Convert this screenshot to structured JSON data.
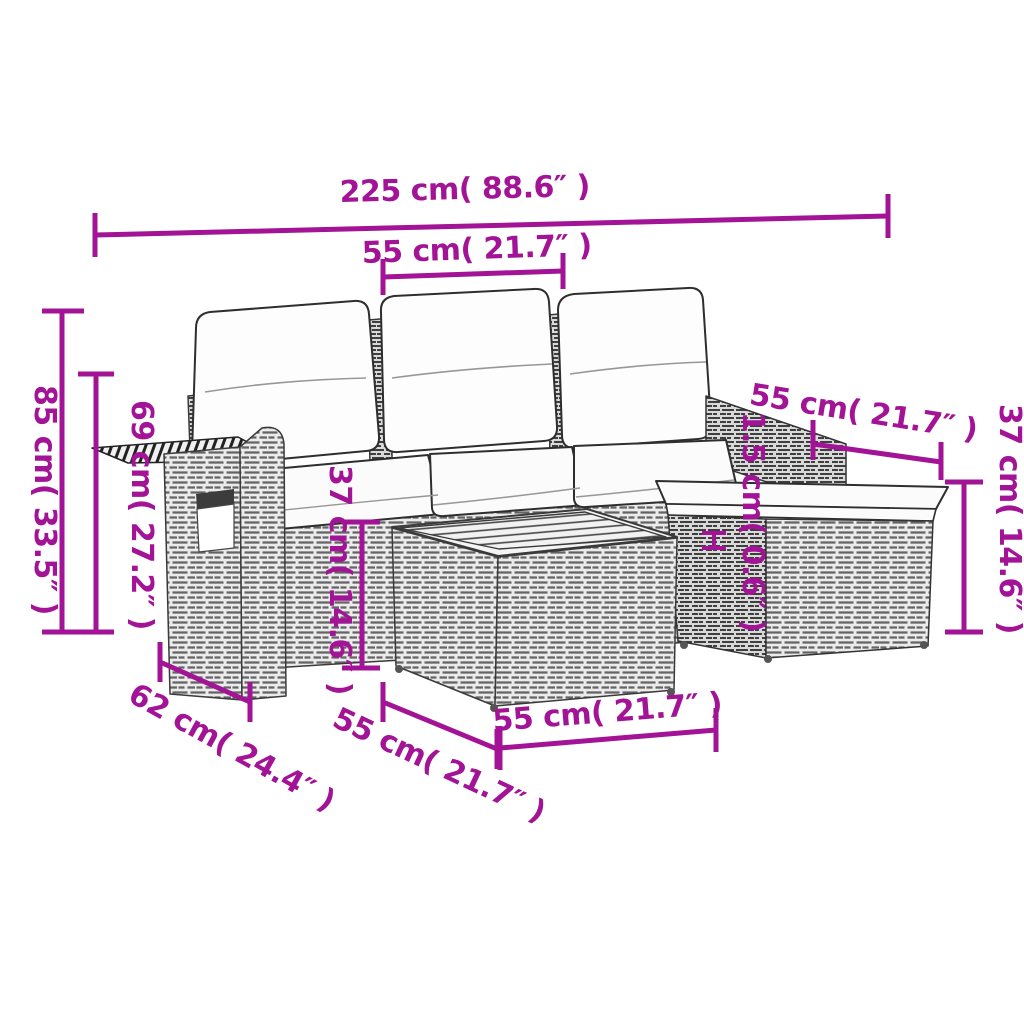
{
  "image_type": "product-dimension-diagram",
  "product": "rattan-garden-sofa-set-with-cushions-stool-and-table",
  "colors": {
    "dimension_accent": "#A21396",
    "line_art": "#3a3a3a",
    "background": "#ffffff"
  },
  "dimensions": {
    "total_width": "225 cm( 88.6″ )",
    "seat_width": "55 cm( 21.7″ )",
    "total_height": "85 cm( 33.5″ )",
    "armrest_height": "69 cm( 27.2″ )",
    "table_height": "37 cm( 14.6″ )",
    "right_section_width": "55 cm( 21.7″ )",
    "cushion_thickness": "1.5 cm( 0.6″ )",
    "stool_height": "37 cm( 14.6″ )",
    "seat_depth": "62 cm( 24.4″ )",
    "table_depth": "55 cm( 21.7″ )",
    "table_width": "55 cm( 21.7″ )"
  }
}
